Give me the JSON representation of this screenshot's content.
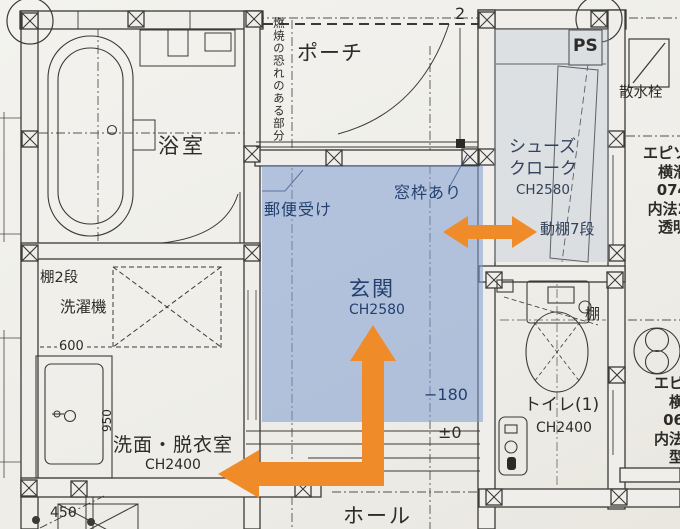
{
  "rooms": {
    "bathroom": {
      "name": "浴室"
    },
    "porch": {
      "name": "ポーチ"
    },
    "entrance": {
      "name": "玄関",
      "ceiling": "CH2580"
    },
    "shoe_closet": {
      "line1": "シューズ",
      "line2": "クローク",
      "ceiling": "CH2580"
    },
    "toilet": {
      "name": "トイレ(1)",
      "ceiling": "CH2400"
    },
    "washroom": {
      "name": "洗面・脱衣室",
      "ceiling": "CH2400"
    },
    "hall": {
      "name": "ホール"
    }
  },
  "labels": {
    "mailbox": "郵便受け",
    "window_frame": "窓枠あり",
    "movable_shelf": "動棚7段",
    "ps": "PS",
    "water_tap": "散水栓",
    "shelf": "棚",
    "shelf_two": "棚2段",
    "washing_machine": "洗濯機",
    "combustion_note": "燃焼の恐れのある部分"
  },
  "dimensions": {
    "d600": "600",
    "d950": "950",
    "d450": "450",
    "grid_no": "2",
    "level_minus": "−180",
    "level_zero": "±0"
  },
  "window_specs": {
    "top": [
      "エピソ",
      "横滑",
      "074",
      "内法2",
      "透明"
    ],
    "bottom": [
      "エピ",
      "横",
      "06",
      "内法",
      "型"
    ]
  },
  "colors": {
    "highlight_blue": "#7f9cd0",
    "closet_blue": "#aebcd0",
    "arrow_orange": "#ef8b28",
    "line": "#3c3a37",
    "paper": "#f0eeea"
  }
}
